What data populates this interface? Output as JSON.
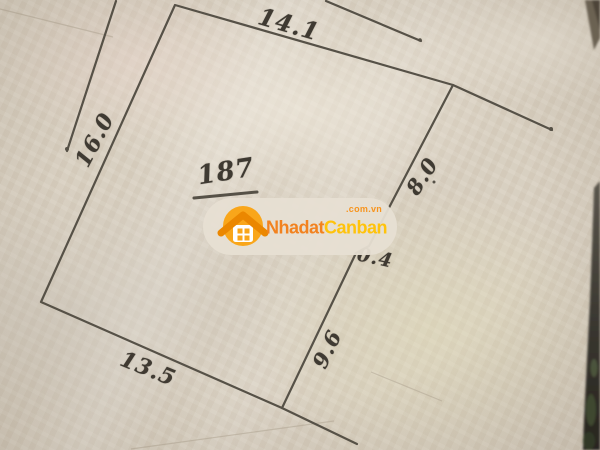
{
  "sketch": {
    "parcel_number": "187",
    "dimension_labels": {
      "top": "14.1",
      "left": "16.0",
      "right_upper": "8.0",
      "right_middle": "0.4",
      "right_lower": "9.6",
      "bottom": "13.5"
    }
  },
  "watermark": {
    "logo_icon": "house-icon",
    "brand_part1": "Nhadat",
    "brand_part2": "Canban",
    "domain_suffix": ".com.vn"
  },
  "css_vars": {
    "ink": "#565147",
    "paper": "#d9d0c1",
    "brand-orange": "#F2821F",
    "brand-yellow": "#FFC30B",
    "circle-orange": "#F9A61A",
    "roof-orange": "#EB8700",
    "suffix-orange": "#F7941D",
    "pill-bg": "rgba(231,223,211,0.95)"
  }
}
